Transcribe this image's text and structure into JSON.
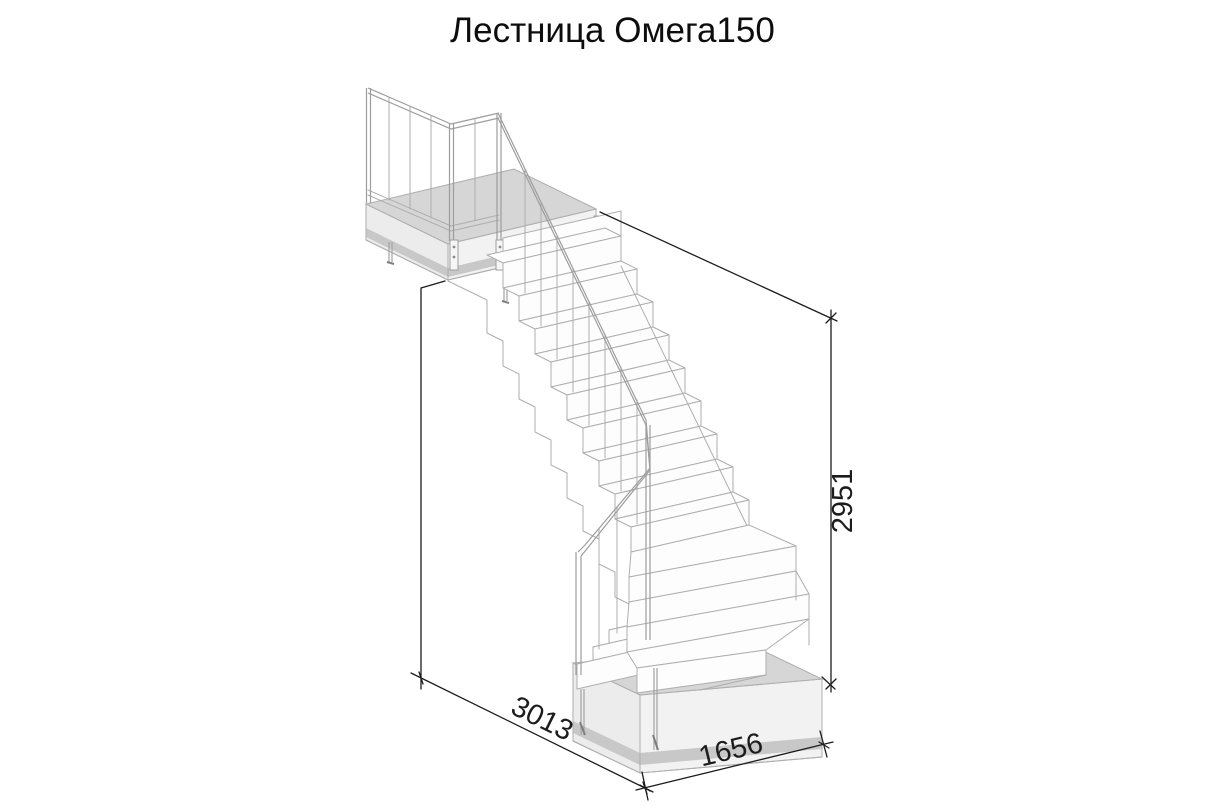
{
  "title": "Лестница Омега150",
  "dimensions": {
    "height": "2951",
    "length": "3013",
    "width": "1656"
  },
  "drawing_labels": {
    "kind": "staircase-isometric-wireframe"
  },
  "colors": {
    "line": "#aeaeae",
    "ink": "#1c1c1c",
    "face_top": "#d6d6d6",
    "face_side": "#ececec",
    "face_band": "#c8c8c8"
  }
}
